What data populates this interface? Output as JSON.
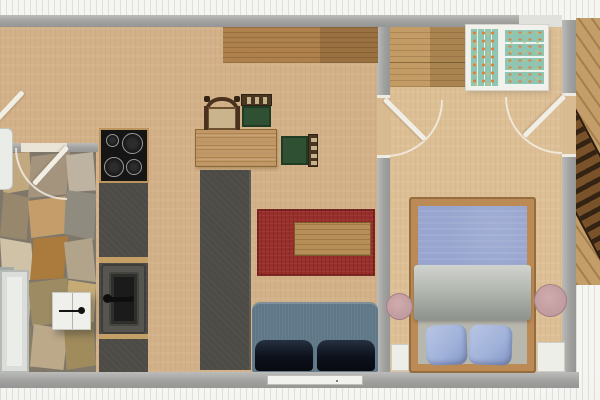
{
  "meta": {
    "description": "Top-down 2D floor plan of a small one-bedroom apartment: kitchen and living-dining room on the left, stone-floored bath/entry room lower left, bedroom on the right, wooden terrace strip along the right edge. No visible text in the image."
  },
  "colors": {
    "outside_decking": "#f7f7f4",
    "wall": "#a7a7a5",
    "floor_living_wood": "#d6b286",
    "floor_bedroom_wood": "#e0c094",
    "stone_grout": "#7e7769",
    "kitchen_counter": "#4b4a45",
    "cooktop": "#131313",
    "sink_basin": "#191919",
    "sideboard_wood": "#b08049",
    "dining_table_wood": "#c49862",
    "chair_seat_green": "#2c4f31",
    "chair_frame_brown": "#46341e",
    "area_rug_red": "#9d2b27",
    "coffee_table_wood": "#b98e55",
    "sofa_body": "#5e7787",
    "sofa_cushion": "#0a0f1a",
    "bed_frame_wood": "#bf8a50",
    "bed_duvet_blue": "#97a6d2",
    "bed_sheet_gray": "#b4b9b2",
    "pillow_blue": "#9fb2dd",
    "wardrobe_interior_mint": "#8fc7b4",
    "wardrobe_dots_orange": "#e0813c",
    "round_rug_pink": "#c39a9e",
    "terrace_deck_wood": "#c79e66",
    "stairs_dark_wood": "#33200f",
    "white_fixtures": "#f0f0ea"
  },
  "rooms": [
    {
      "id": "kitchen-living",
      "label": "kitchen / dining / living room",
      "floor": "light wood"
    },
    {
      "id": "stone-room",
      "label": "bath / entry room",
      "floor": "natural stone mosaic"
    },
    {
      "id": "bedroom",
      "label": "bedroom",
      "floor": "light wood"
    },
    {
      "id": "terrace",
      "label": "terrace / deck",
      "floor": "wood planks + white planks"
    }
  ],
  "furniture": [
    {
      "id": "cooktop",
      "room": "kitchen-living",
      "label": "4-burner cooktop"
    },
    {
      "id": "kitchen-counter",
      "room": "kitchen-living",
      "label": "dark counter run along left wall"
    },
    {
      "id": "sink",
      "room": "kitchen-living",
      "label": "sink with faucet"
    },
    {
      "id": "island-counter",
      "room": "kitchen-living",
      "label": "tall dark island / cabinet"
    },
    {
      "id": "sideboard",
      "room": "kitchen-living",
      "label": "wood sideboard along top wall"
    },
    {
      "id": "dining-table",
      "room": "kitchen-living",
      "label": "rectangular dining table"
    },
    {
      "id": "wooden-armchair",
      "room": "kitchen-living",
      "label": "wooden armchair with arched back"
    },
    {
      "id": "green-chair-top",
      "room": "kitchen-living",
      "label": "green upholstered chair (above table)"
    },
    {
      "id": "green-chair-right",
      "room": "kitchen-living",
      "label": "green upholstered chair (right of table)"
    },
    {
      "id": "area-rug",
      "room": "kitchen-living",
      "label": "red area rug"
    },
    {
      "id": "coffee-table",
      "room": "kitchen-living",
      "label": "low wooden table on rug"
    },
    {
      "id": "sofa",
      "room": "kitchen-living",
      "label": "two-seat sofa against bottom wall"
    },
    {
      "id": "radiator",
      "room": "stone-room",
      "label": "white radiator / appliance on left wall"
    },
    {
      "id": "wall-cabinet",
      "room": "stone-room",
      "label": "white two-door cabinet with handle"
    },
    {
      "id": "white-fixture",
      "room": "stone-room",
      "label": "small white fixture at left edge"
    },
    {
      "id": "dresser",
      "room": "bedroom",
      "label": "wooden dresser along top wall"
    },
    {
      "id": "wardrobe",
      "room": "bedroom",
      "label": "open wardrobe with mint/orange clothes shelves"
    },
    {
      "id": "double-bed",
      "room": "bedroom",
      "label": "double bed, blue duvet, folded gray sheet, two blue pillows"
    },
    {
      "id": "round-rug-left",
      "room": "bedroom",
      "label": "round pink rug left of bed"
    },
    {
      "id": "round-rug-right",
      "room": "bedroom",
      "label": "round pink rug right of bed"
    },
    {
      "id": "nightstand-left",
      "room": "bedroom",
      "label": "white nightstand left of bed head"
    },
    {
      "id": "nightstand-right",
      "room": "bedroom",
      "label": "white nightstand right of bed head"
    },
    {
      "id": "deck-stairs",
      "room": "terrace",
      "label": "dark wooden steps on deck"
    }
  ],
  "doors": [
    {
      "id": "door-top-left",
      "location": "left edge of plan near kitchen",
      "state": "open leaf shown"
    },
    {
      "id": "door-stone-room",
      "location": "wall between kitchen and stone room",
      "swing": "into stone room"
    },
    {
      "id": "door-bedroom",
      "location": "partition wall living room / bedroom",
      "swing": "into bedroom"
    },
    {
      "id": "door-terrace",
      "location": "right exterior wall",
      "swing": "into bedroom"
    }
  ],
  "windows": [
    {
      "id": "window-living",
      "location": "bottom wall behind sofa"
    }
  ]
}
